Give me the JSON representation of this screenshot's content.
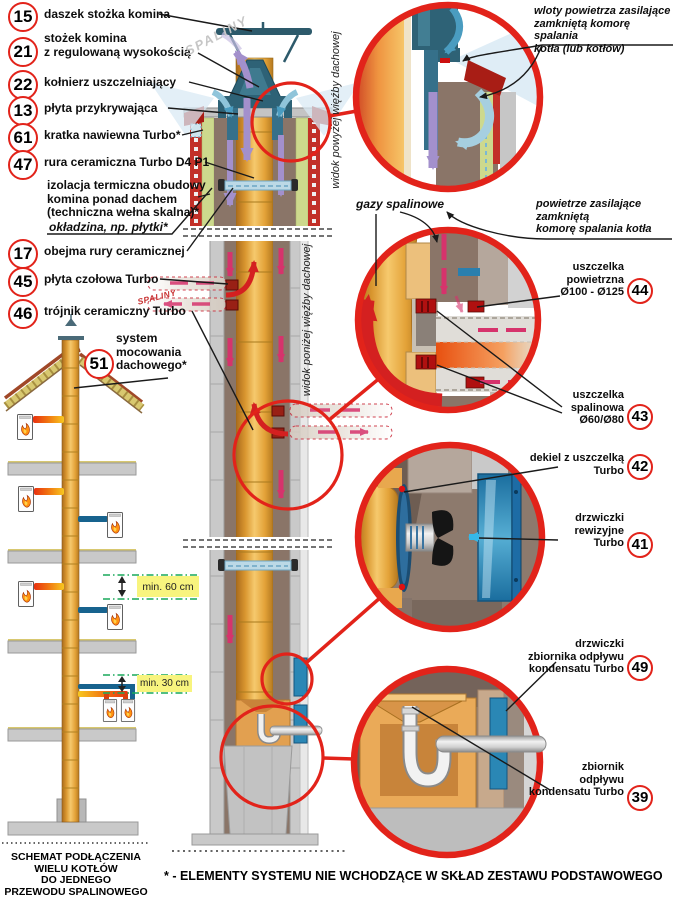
{
  "colors": {
    "accent_red": "#e2231a",
    "ceramic_orange": "#eaa93f",
    "insulation_green": "#cdd98d",
    "brick_red": "#c23028",
    "cap_teal": "#2e6276",
    "door_blue": "#2a87b5",
    "arrow_purple": "#a390cc",
    "arrow_pink": "#d6336c",
    "arrow_red": "#d42020",
    "dimension_green": "#18a85a",
    "highlight_yellow": "#f8f47e"
  },
  "watermarks": {
    "top": "SPALINY",
    "mid": "SPALINY"
  },
  "views": {
    "above": "widok powyżej więźby dachowej",
    "below": "widok poniżej więźby dachowej"
  },
  "callouts": {
    "c15": {
      "num": "15",
      "label": "daszek stożka komina"
    },
    "c21": {
      "num": "21",
      "label": "stożek komina\nz regulowaną wysokością"
    },
    "c22": {
      "num": "22",
      "label": "kołnierz uszczelniający"
    },
    "c13": {
      "num": "13",
      "label": "płyta przykrywająca"
    },
    "c61": {
      "num": "61",
      "label": "kratka nawiewna Turbo*"
    },
    "c47": {
      "num": "47",
      "label": "rura ceramiczna Turbo D4 P1"
    },
    "izolacja": {
      "label": "izolacja termiczna obudowy\nkomina ponad dachem\n(techniczna wełna skalna)*"
    },
    "okladzina": {
      "label": "okładzina, np. płytki*"
    },
    "c17": {
      "num": "17",
      "label": "obejma rury ceramicznej"
    },
    "c45": {
      "num": "45",
      "label": "płyta czołowa Turbo"
    },
    "c46": {
      "num": "46",
      "label": "trójnik ceramiczny Turbo"
    },
    "c51": {
      "num": "51",
      "label": "system\nmocowania\ndachowego*"
    },
    "wloty": {
      "label": "wloty powietrza zasilające\nzamkniętą komorę spalania\nkotła (lub kotłów)"
    },
    "gazy": {
      "label": "gazy spalinowe"
    },
    "powietrze": {
      "label": "powietrze zasilające\nzamkniętą\nkomorę spalania kotła"
    },
    "c44": {
      "num": "44",
      "label": "uszczelka\npowietrzna\nØ100 - Ø125"
    },
    "c43": {
      "num": "43",
      "label": "uszczelka\nspalinowa\nØ60/Ø80"
    },
    "c42": {
      "num": "42",
      "label": "dekiel z uszczelką\nTurbo"
    },
    "c41": {
      "num": "41",
      "label": "drzwiczki\nrewizyjne\nTurbo"
    },
    "c49": {
      "num": "49",
      "label": "drzwiczki\nzbiornika odpływu\nkondensatu Turbo"
    },
    "c39": {
      "num": "39",
      "label": "zbiornik\nodpływu\nkondensatu Turbo"
    }
  },
  "dimensions": {
    "min60": "min. 60 cm",
    "min30": "min. 30 cm"
  },
  "schematic_title": "SCHEMAT PODŁĄCZENIA\nWIELU KOTŁÓW\nDO JEDNEGO\nPRZEWODU SPALINOWEGO",
  "footnote": "* - ELEMENTY SYSTEMU NIE WCHODZĄCE W SKŁAD ZESTAWU PODSTAWOWEGO"
}
